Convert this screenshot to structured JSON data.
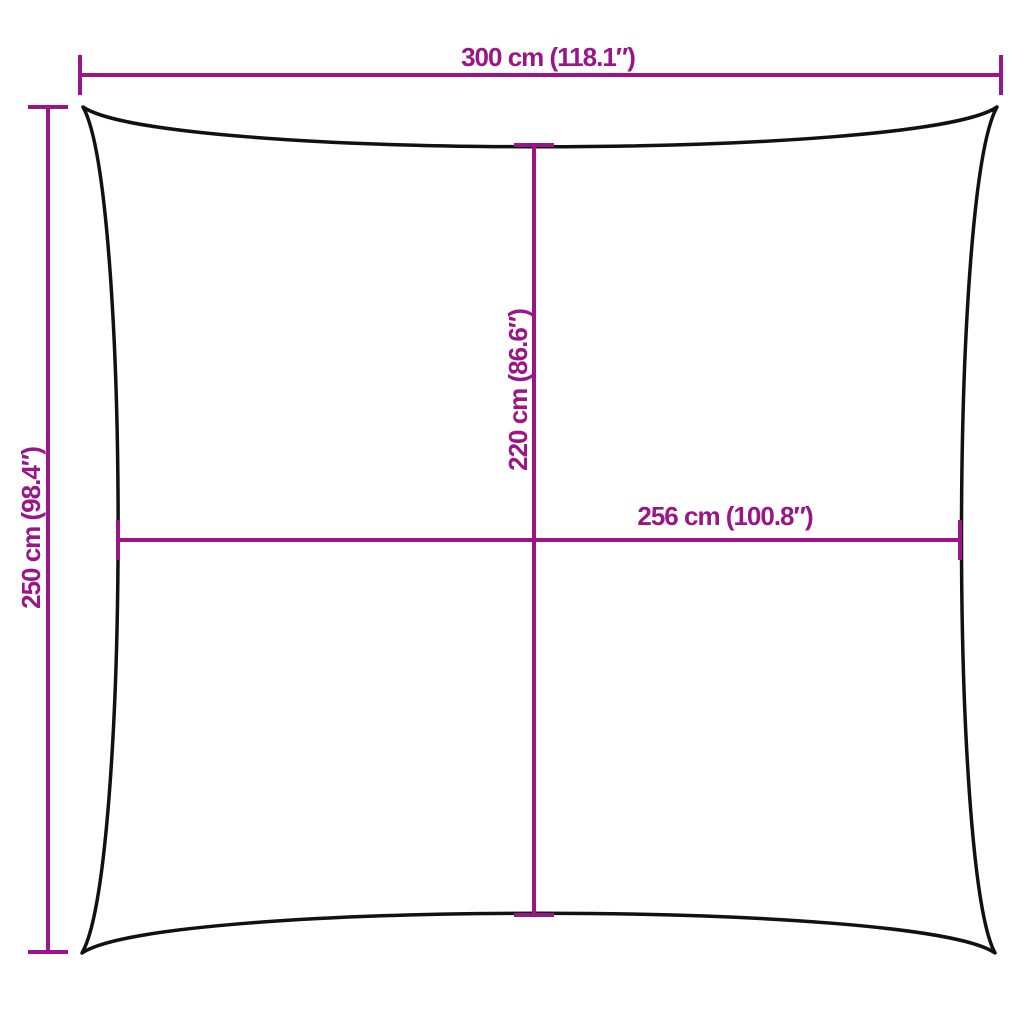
{
  "diagram": {
    "colors": {
      "dimension": "#9A1688",
      "outline": "#111111",
      "background": "#ffffff"
    },
    "dimensions": {
      "top_width": "300 cm (118.1″)",
      "left_height": "250 cm (98.4″)",
      "inner_height": "220 cm (86.6″)",
      "inner_width": "256 cm (100.8″)"
    }
  }
}
